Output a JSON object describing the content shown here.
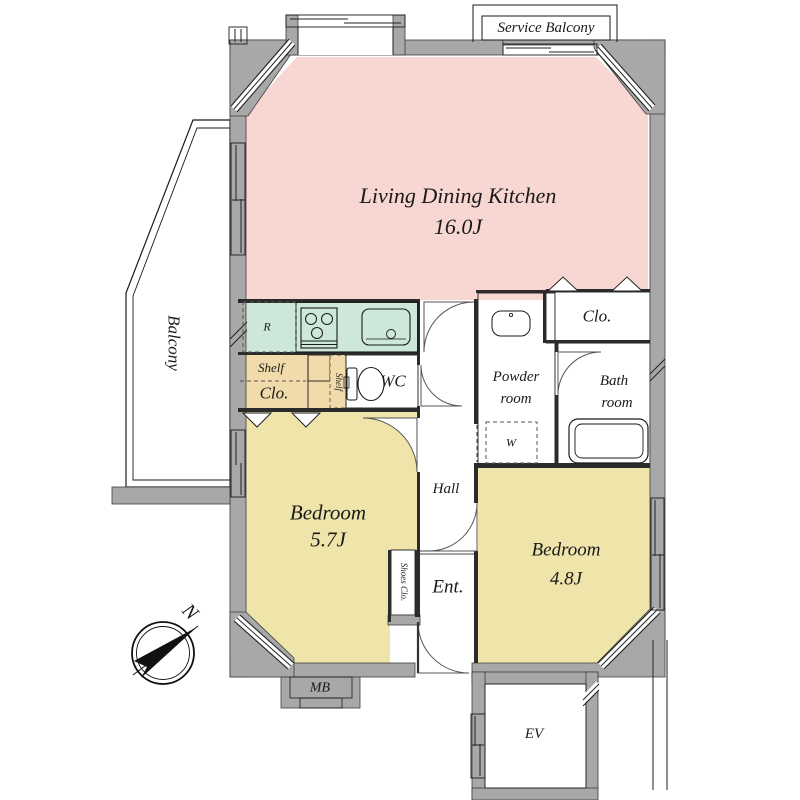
{
  "colors": {
    "ldk_pink": "#f8d7d2",
    "bedroom_yellow": "#efe5ab",
    "wet_area_green": "#cde7da",
    "closet_tan": "#f2dbab",
    "wall_gray": "#a8a8a8",
    "line_black": "#1a1a1a"
  },
  "rooms": {
    "ldk": {
      "name": "Living Dining Kitchen",
      "size": "16.0J"
    },
    "bedroom1": {
      "name": "Bedroom",
      "size": "5.7J"
    },
    "bedroom2": {
      "name": "Bedroom",
      "size": "4.8J"
    },
    "balcony": {
      "name": "Balcony"
    },
    "service_balcony": {
      "name": "Service Balcony"
    },
    "hall": {
      "name": "Hall"
    },
    "entrance": {
      "name": "Ent."
    },
    "wc": {
      "name": "WC"
    },
    "powder_room": {
      "line1": "Powder",
      "line2": "room"
    },
    "bath_room": {
      "line1": "Bath",
      "line2": "room"
    },
    "closet_ldk": {
      "name": "Clo."
    },
    "closet_bedroom1": {
      "shelf_label": "Shelf",
      "name": "Clo."
    },
    "shelf_column": {
      "name": "Shelf"
    },
    "shoes_closet": {
      "name": "Shoes Clo."
    },
    "washer_space": {
      "name": "W"
    },
    "refrigerator_space": {
      "name": "R"
    },
    "meter_box": {
      "name": "MB"
    },
    "elevator": {
      "name": "EV"
    }
  },
  "compass": {
    "north": "N"
  }
}
